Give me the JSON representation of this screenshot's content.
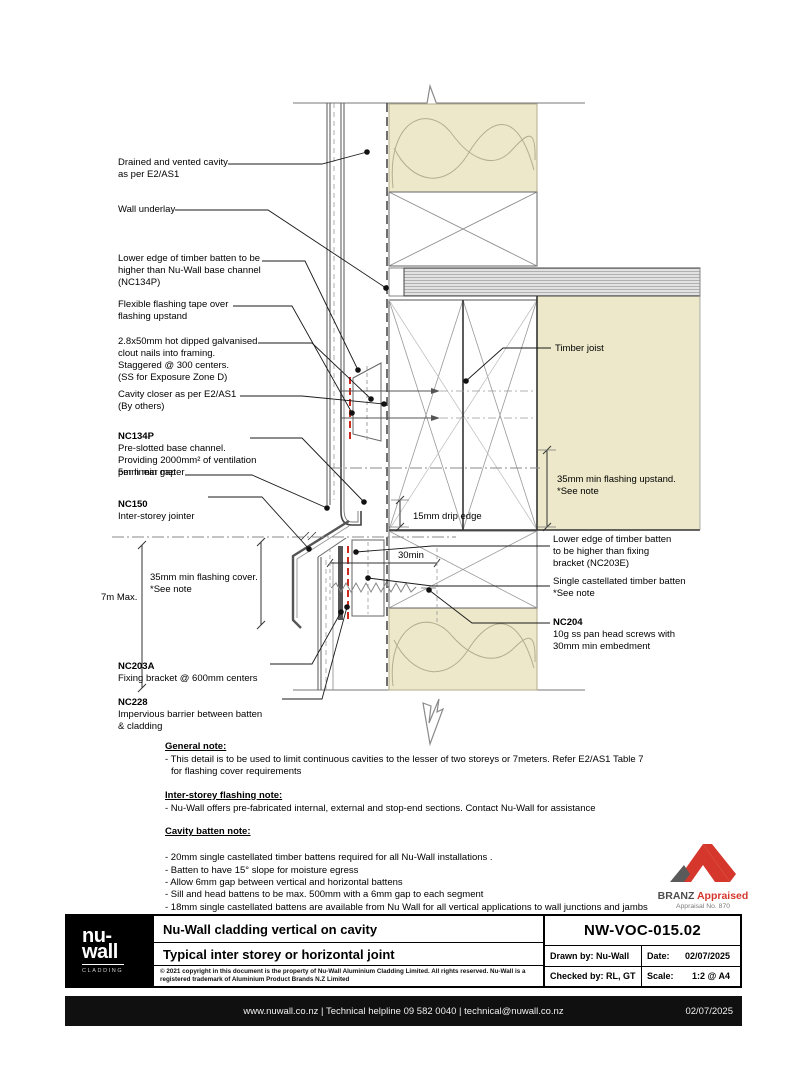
{
  "callouts": {
    "cavity": "Drained and vented cavity\nas per  E2/AS1",
    "underlay": "Wall underlay",
    "batten_edge_left": "Lower edge of timber batten to be\nhigher than Nu-Wall base channel\n(NC134P)",
    "tape": "Flexible flashing tape over\nflashing upstand",
    "nails": "2.8x50mm hot dipped galvanised\nclout nails into framing.\nStaggered @ 300 centers.\n(SS for Exposure Zone D)",
    "closer": "Cavity closer as per E2/AS1\n(By others)",
    "nc134p_code": "NC134P",
    "nc134p_text": "Pre-slotted base channel.\nProviding 2000mm² of ventilation\nper linear meter",
    "gap": "5mm min gap",
    "nc150_code": "NC150",
    "nc150_text": "Inter-storey jointer",
    "cover": "35mm min flashing cover.\n*See note",
    "max_height": "7m Max.",
    "nc203a_code": "NC203A",
    "nc203a_text": "Fixing bracket @ 600mm centers",
    "nc228_code": "NC228",
    "nc228_text": "Impervious barrier between batten\n& cladding",
    "joist": "Timber joist",
    "upstand": "35mm min flashing upstand.\n*See note",
    "drip": "15mm drip edge",
    "batten_gap": "30min",
    "batten_edge_right": "Lower edge of timber batten\nto be higher than fixing\nbracket (NC203E)",
    "single_batten": "Single castellated timber batten\n*See note",
    "nc204_code": "NC204",
    "nc204_text": "10g ss pan head screws with\n30mm min embedment"
  },
  "notes": {
    "general": {
      "heading": "General note:",
      "line1": "- This detail is to be used to limit continuous cavities to the lesser of two storeys or 7meters. Refer E2/AS1 Table 7",
      "line2": "for flashing cover requirements"
    },
    "interstorey": {
      "heading": "Inter-storey flashing note:",
      "line1": "- Nu-Wall offers pre-fabricated internal, external and stop-end sections. Contact Nu-Wall for assistance"
    },
    "cavity_batten": {
      "heading": "Cavity batten note:",
      "items": [
        "- 20mm single castellated timber battens required for all Nu-Wall installations .",
        "- Batten to have 15° slope for moisture egress",
        "- Allow 6mm gap between vertical and horizontal battens",
        "- Sill and head battens to be max. 500mm with a 6mm gap to each segment",
        "- 18mm single castellated battens are available from Nu Wall for all vertical applications to wall junctions and jambs",
        "- Proprietary Nu-Wall Albat is available as an alternative when a structural non-combustable cavity batten is required"
      ]
    }
  },
  "branz": {
    "name_dark": "BRANZ",
    "name_red": "Appraised",
    "sub": "Appraisal No. 870"
  },
  "logo": {
    "line1": "nu-",
    "line2": "wall",
    "sub": "CLADDING"
  },
  "titleblock": {
    "title1": "Nu-Wall cladding vertical on cavity",
    "title2": "Typical inter storey or horizontal joint",
    "copyright": "© 2021 copyright in this document is the property of Nu-Wall Aluminium Cladding Limited.  All rights reserved.  Nu-Wall is a\nregistered trademark of Aluminium Product Brands N.Z Limited",
    "number": "NW-VOC-015.02",
    "drawn_label": "Drawn by: Nu-Wall",
    "date_label": "Date:",
    "date_value": "02/07/2025",
    "checked_label": "Checked by: RL, GT",
    "scale_label": "Scale:",
    "scale_value": "1:2 @ A4"
  },
  "footer": {
    "center": "www.nuwall.co.nz  |  Technical helpline 09 582 0040  |  technical@nuwall.co.nz",
    "date": "02/07/2025"
  },
  "colors": {
    "insulation": "#ece8c9",
    "tape_red": "#cc2a1f",
    "branz_red": "#d6372c",
    "line_dark": "#333333"
  }
}
